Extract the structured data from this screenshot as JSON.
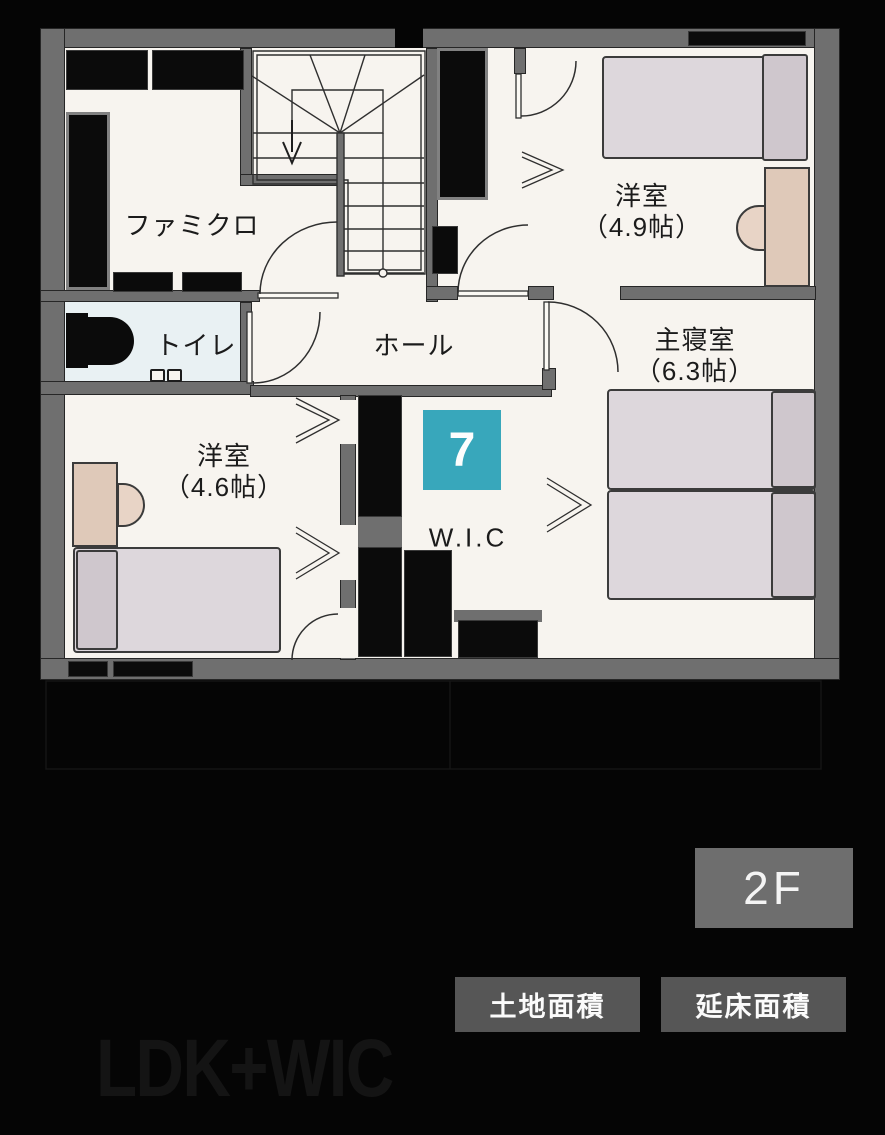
{
  "floor_plan": {
    "rooms": {
      "famiclo": {
        "label": "ファミクロ"
      },
      "toilet": {
        "label": "トイレ"
      },
      "hall": {
        "label": "ホール"
      },
      "bedroom_49": {
        "name": "洋室",
        "size": "（4.9帖）"
      },
      "master_bedroom": {
        "name": "主寝室",
        "size": "（6.3帖）"
      },
      "bedroom_46": {
        "name": "洋室",
        "size": "（4.6帖）"
      },
      "wic": {
        "label": "W.I.C"
      }
    },
    "plan_badge": {
      "number": "7"
    }
  },
  "floor_label": {
    "text": "2F"
  },
  "area_badges": {
    "land": "土地面積",
    "total_floor": "延床面積"
  },
  "watermark": {
    "text": "LDK+WIC"
  },
  "colors": {
    "background": "#050505",
    "floor_white": "#f7f4ef",
    "wall_gray": "#6f6f6f",
    "toilet_blue": "#e9f1f3",
    "badge_teal": "#38a7bb",
    "floor_badge_gray": "#6e6e6e",
    "area_badge_gray": "#565656",
    "bed_fill": "#ddd7dc",
    "desk_fill": "#dfc9b9"
  }
}
